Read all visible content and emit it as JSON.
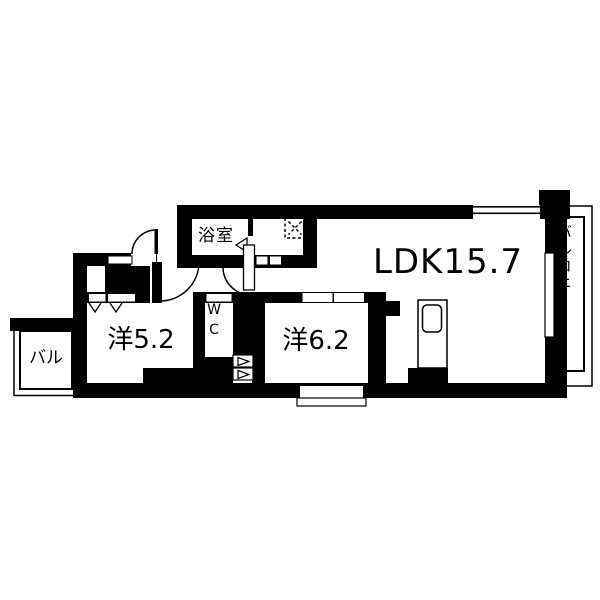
{
  "plan": {
    "type": "apartment-floor-plan",
    "labels": {
      "ldk": "LDK15.7",
      "bath": "浴室",
      "room_a": "洋5.2",
      "room_b": "洋6.2",
      "wc": "WC",
      "balcony": "バルコニー",
      "balcony_small": "バル"
    },
    "colors": {
      "wall": "#000000",
      "background": "#ffffff",
      "line": "#000000"
    }
  }
}
